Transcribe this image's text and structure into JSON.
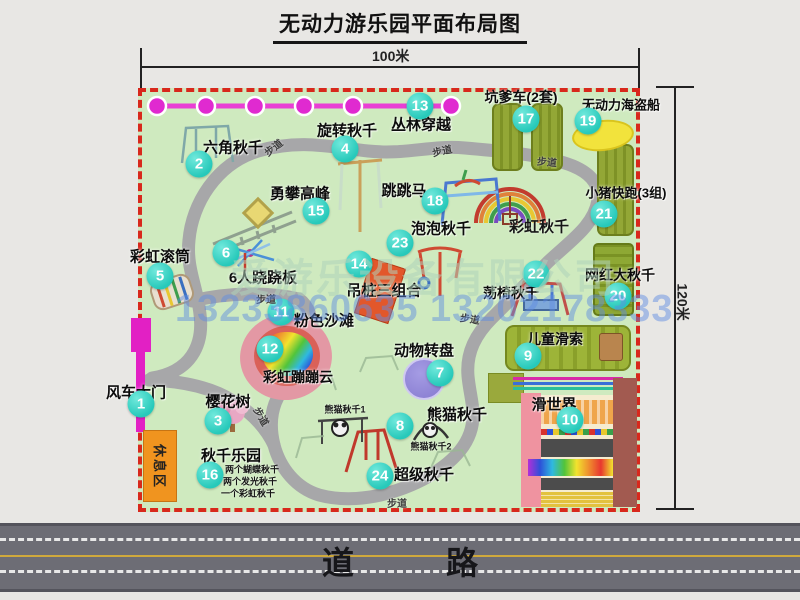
{
  "title": "无动力游乐园平面布局图",
  "dimensions": {
    "width_label": "100米",
    "height_label": "120米"
  },
  "road": {
    "label": "道　路"
  },
  "watermarks": {
    "company": "爱游乐设备有限公司",
    "phones": "13233860635 13202178333"
  },
  "rest_area_label": "休息区",
  "colors": {
    "park_green": "#cfeabf",
    "border_red": "#d8281c",
    "path_gray": "#a7a7a9",
    "badge_teal": "#27c9ba",
    "gate_magenta": "#e220c4",
    "zipline_magenta": "#e93fd4",
    "rest_orange": "#f0941f",
    "equip_olive": "#93a736",
    "road_gray": "#6d6d75",
    "pirate_yellow": "#f2e33c",
    "wheel_purple": "#8579cf",
    "beach_pink": "#e398a4"
  },
  "markers": [
    {
      "n": "1",
      "t": "风车大门",
      "bx": 141,
      "by": 404,
      "lx": 136,
      "ly": 392,
      "fs": 15
    },
    {
      "n": "2",
      "t": "六角秋千",
      "bx": 199,
      "by": 164,
      "lx": 233,
      "ly": 147,
      "fs": 15
    },
    {
      "n": "3",
      "t": "樱花树",
      "bx": 218,
      "by": 421,
      "lx": 228,
      "ly": 401,
      "fs": 15
    },
    {
      "n": "4",
      "t": "旋转秋千",
      "bx": 345,
      "by": 149,
      "lx": 347,
      "ly": 130,
      "fs": 15
    },
    {
      "n": "5",
      "t": "彩虹滚筒",
      "bx": 160,
      "by": 276,
      "lx": 160,
      "ly": 256,
      "fs": 15
    },
    {
      "n": "6",
      "t": "6人跷跷板",
      "bx": 226,
      "by": 253,
      "lx": 263,
      "ly": 277,
      "fs": 15
    },
    {
      "n": "7",
      "t": "动物转盘",
      "bx": 440,
      "by": 373,
      "lx": 424,
      "ly": 350,
      "fs": 15
    },
    {
      "n": "8",
      "t": "熊猫秋千",
      "bx": 400,
      "by": 426,
      "lx": 457,
      "ly": 414,
      "fs": 15
    },
    {
      "n": "9",
      "t": "儿童滑索",
      "bx": 528,
      "by": 356,
      "lx": 555,
      "ly": 339,
      "fs": 14
    },
    {
      "n": "10",
      "t": "滑世界",
      "bx": 570,
      "by": 420,
      "lx": 554,
      "ly": 404,
      "fs": 15
    },
    {
      "n": "11",
      "t": "粉色沙滩",
      "bx": 281,
      "by": 312,
      "lx": 324,
      "ly": 320,
      "fs": 15
    },
    {
      "n": "12",
      "t": "彩虹蹦蹦云",
      "bx": 270,
      "by": 349,
      "lx": 298,
      "ly": 377,
      "fs": 14
    },
    {
      "n": "13",
      "t": "丛林穿越",
      "bx": 420,
      "by": 106,
      "lx": 421,
      "ly": 124,
      "fs": 15
    },
    {
      "n": "14",
      "t": "吊桩三组合",
      "bx": 359,
      "by": 264,
      "lx": 384,
      "ly": 290,
      "fs": 15
    },
    {
      "n": "15",
      "t": "勇攀高峰",
      "bx": 316,
      "by": 211,
      "lx": 300,
      "ly": 193,
      "fs": 15
    },
    {
      "n": "16",
      "t": "秋千乐园",
      "bx": 210,
      "by": 475,
      "lx": 231,
      "ly": 455,
      "fs": 15
    },
    {
      "n": "17",
      "t": "坑爹车(2套)",
      "bx": 526,
      "by": 119,
      "lx": 521,
      "ly": 97,
      "fs": 14
    },
    {
      "n": "18",
      "t": "跳跳马",
      "bx": 435,
      "by": 201,
      "lx": 404,
      "ly": 190,
      "fs": 15
    },
    {
      "n": "19",
      "t": "无动力海盗船",
      "bx": 588,
      "by": 121,
      "lx": 621,
      "ly": 104,
      "fs": 13
    },
    {
      "n": "20",
      "t": "网红大秋千",
      "bx": 618,
      "by": 296,
      "lx": 620,
      "ly": 275,
      "fs": 14
    },
    {
      "n": "21",
      "t": "小猪快跑(3组)",
      "bx": 604,
      "by": 214,
      "lx": 626,
      "ly": 192,
      "fs": 13
    },
    {
      "n": "22",
      "t": "荡椅秋千",
      "bx": 536,
      "by": 274,
      "lx": 511,
      "ly": 293,
      "fs": 14
    },
    {
      "n": "23",
      "t": "泡泡秋千",
      "bx": 400,
      "by": 243,
      "lx": 441,
      "ly": 228,
      "fs": 15
    },
    {
      "n": "24",
      "t": "超级秋千",
      "bx": 380,
      "by": 476,
      "lx": 424,
      "ly": 474,
      "fs": 15
    }
  ],
  "plain_labels": [
    {
      "t": "彩虹秋千",
      "x": 539,
      "y": 226,
      "fs": 15
    },
    {
      "t": "熊猫秋千1",
      "x": 345,
      "y": 409,
      "fs": 9
    },
    {
      "t": "熊猫秋千2",
      "x": 431,
      "y": 446,
      "fs": 9
    },
    {
      "t": "两个蝴蝶秋千",
      "x": 252,
      "y": 469,
      "fs": 9
    },
    {
      "t": "两个发光秋千",
      "x": 250,
      "y": 481,
      "fs": 9
    },
    {
      "t": "一个彩虹秋千",
      "x": 248,
      "y": 493,
      "fs": 9
    }
  ],
  "path_labels": [
    {
      "t": "步道",
      "x": 273,
      "y": 147,
      "r": -38
    },
    {
      "t": "步道",
      "x": 442,
      "y": 150,
      "r": -12
    },
    {
      "t": "步道",
      "x": 547,
      "y": 161,
      "r": 5
    },
    {
      "t": "步道",
      "x": 256,
      "y": 291,
      "r": 0
    },
    {
      "t": "步道",
      "x": 470,
      "y": 318,
      "r": 8
    },
    {
      "t": "步道",
      "x": 387,
      "y": 495,
      "r": 0
    },
    {
      "t": "步道",
      "x": 262,
      "y": 416,
      "r": 60
    }
  ]
}
